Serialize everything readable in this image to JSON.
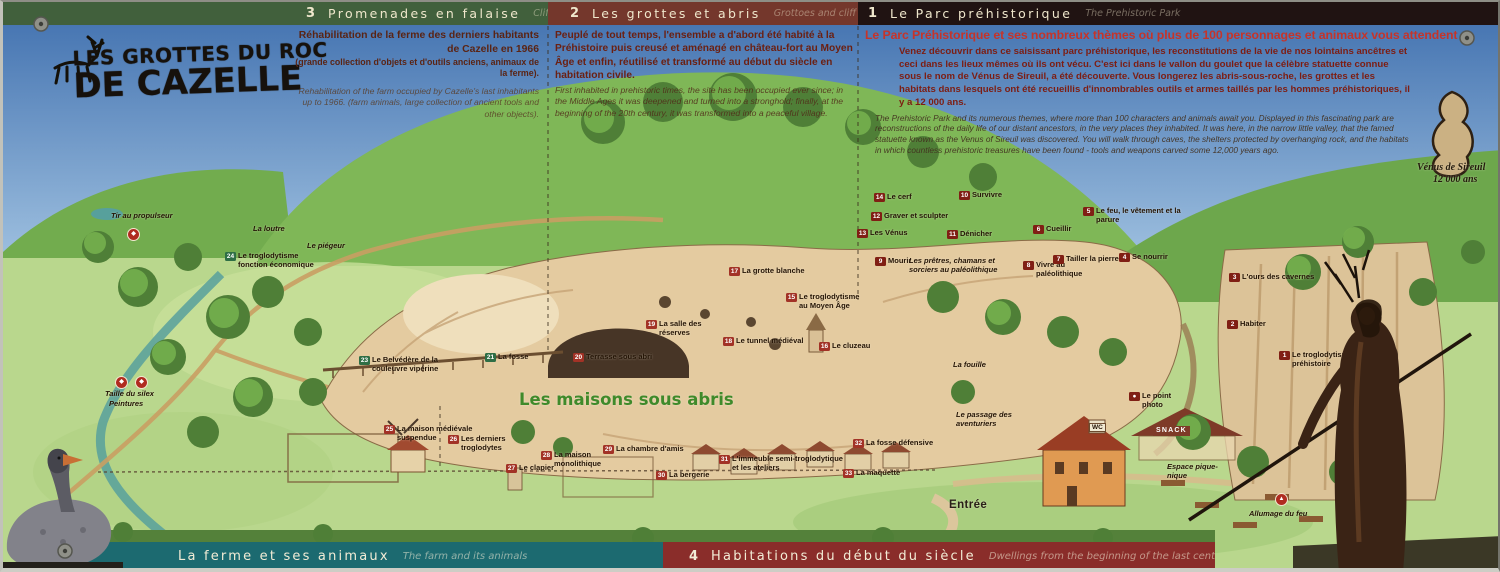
{
  "sign": {
    "title": {
      "line1": "LES GROTTES DU ROC",
      "line2": "DE CAZELLE"
    },
    "top_sections": [
      {
        "num": "3",
        "title": "Promenades en falaise",
        "title_en": "Cliff Walks",
        "fr": "Réhabilitation de la ferme des derniers habitants de Cazelle en 1966",
        "fr_note": "(grande collection d'objets et d'outils anciens, animaux de la ferme).",
        "en": "Rehabilitation of the farm occupied by Cazelle's last inhabitants up to 1966. (farm animals, large collection of ancient tools and other objects)."
      },
      {
        "num": "2",
        "title": "Les grottes et abris",
        "title_en": "Grottoes and cliff shelters",
        "fr": "Peuplé de tout temps, l'ensemble a d'abord été habité à la Préhistoire puis creusé et aménagé en château-fort au Moyen Âge et enfin, réutilisé et transformé au début du siècle en habitation civile.",
        "en": "First inhabited in prehistoric times, the site has been occupied ever since; in the Middle Ages it was deepened and turned into a stronghold; finally, at the beginning of the 20th century, it was transformed into a peaceful village."
      },
      {
        "num": "1",
        "title": "Le Parc préhistorique",
        "title_en": "The Prehistoric Park",
        "headline": "Le Parc Préhistorique et ses nombreux thèmes où plus de 100 personnages et animaux vous attendent",
        "fr": "Venez découvrir dans ce saisissant parc préhistorique, les reconstitutions de la vie de nos lointains ancêtres et ceci dans les lieux mêmes où ils ont vécu. C'est ici dans le vallon du goulet que la célèbre statuette connue sous le nom de Vénus de Sireuil, a été découverte. Vous longerez les abris-sous-roche, les grottes et les habitats dans lesquels ont été recueillis d'innombrables outils et armes taillés par les hommes préhistoriques, il y a 12 000 ans.",
        "en": "The Prehistoric Park and its numerous themes, where more than 100 characters and animals await you. Displayed in this fascinating park are reconstructions of the daily life of our distant ancestors, in the very places they inhabited. It was here, in the narrow little valley, that the famed statuette known as the Venus of Sireuil was discovered. You will walk through caves, the shelters protected by overhanging rock, and the habitats in which countless prehistoric treasures have been found - tools and weapons carved some 12,000 years ago."
      }
    ],
    "bottom_sections": [
      {
        "title": "La ferme et ses animaux",
        "title_en": "The farm and its animals"
      },
      {
        "num": "4",
        "title": "Habitations du début du siècle",
        "title_en": "Dwellings from the beginning of the last century"
      }
    ],
    "colors": {
      "band_green": "#41603c",
      "band_maroon": "#74372c",
      "band_dark": "#201312",
      "band_teal": "#1c6a70",
      "band_red": "#8a2d2a",
      "chip_green": "#2e6e45",
      "chip_red": "#a23226",
      "chip_park": "#801f14",
      "headline_red": "#c5342a"
    }
  },
  "map": {
    "labels": [
      {
        "t": "Tir au propulseur",
        "x": 108,
        "y": 210,
        "cls": "pl",
        "w": 72,
        "name": "label-tir-au-propulseur"
      },
      {
        "icon": "◆",
        "x": 124,
        "y": 226,
        "iconName": "spear-thrower-activity-icon"
      },
      {
        "t": "La loutre",
        "x": 250,
        "y": 223,
        "cls": "pl"
      },
      {
        "t": "Le piégeur",
        "x": 304,
        "y": 240,
        "cls": "pl"
      },
      {
        "n": "24",
        "c": "g",
        "t": "Le troglodytisme fonction économique",
        "x": 222,
        "y": 250,
        "w": 95
      },
      {
        "n": "23",
        "c": "g",
        "t": "Le Belvédère de la couleuvre vipérine",
        "x": 356,
        "y": 354,
        "w": 105
      },
      {
        "n": "21",
        "c": "g",
        "t": "La fosse",
        "x": 482,
        "y": 351
      },
      {
        "n": "17",
        "c": "r",
        "t": "La grotte blanche",
        "x": 726,
        "y": 265
      },
      {
        "n": "15",
        "c": "r",
        "t": "Le troglodytisme au Moyen Âge",
        "x": 783,
        "y": 291,
        "w": 80
      },
      {
        "n": "19",
        "c": "r",
        "t": "La salle des réserves",
        "x": 643,
        "y": 318,
        "w": 60
      },
      {
        "n": "18",
        "c": "r",
        "t": "Le tunnel médiéval",
        "x": 720,
        "y": 335,
        "w": 95
      },
      {
        "n": "16",
        "c": "r",
        "t": "Le cluzeau",
        "x": 816,
        "y": 340
      },
      {
        "n": "20",
        "c": "r",
        "t": "Terrasse sous abri",
        "x": 570,
        "y": 351,
        "w": 95
      },
      {
        "t": "La fouille",
        "x": 950,
        "y": 359,
        "cls": "pl"
      },
      {
        "t": "Les maisons sous abris",
        "x": 516,
        "y": 390,
        "cls": "big-green",
        "w": 320,
        "name": "label-les-maisons-sous-abris"
      },
      {
        "icon": "◆",
        "x": 112,
        "y": 374,
        "iconName": "flint-knapping-activity-icon"
      },
      {
        "icon": "◆",
        "x": 132,
        "y": 374,
        "iconName": "painting-activity-icon"
      },
      {
        "t": "Taille du silex",
        "x": 102,
        "y": 388,
        "cls": "pl",
        "w": 62
      },
      {
        "t": "Peintures",
        "x": 106,
        "y": 398,
        "cls": "pl"
      },
      {
        "n": "25",
        "c": "r",
        "t": "La maison médiévale suspendue",
        "x": 381,
        "y": 423,
        "w": 90
      },
      {
        "n": "26",
        "c": "r",
        "t": "Les derniers troglodytes",
        "x": 445,
        "y": 433,
        "w": 72
      },
      {
        "n": "27",
        "c": "r",
        "t": "Le clapier",
        "x": 503,
        "y": 462
      },
      {
        "n": "28",
        "c": "r",
        "t": "La maison monolithique",
        "x": 538,
        "y": 449,
        "w": 74
      },
      {
        "n": "29",
        "c": "r",
        "t": "La chambre d'amis",
        "x": 600,
        "y": 443,
        "w": 92
      },
      {
        "n": "30",
        "c": "r",
        "t": "La bergerie",
        "x": 653,
        "y": 469
      },
      {
        "n": "31",
        "c": "r",
        "t": "L'immeuble semi-troglodytique et les ateliers",
        "x": 716,
        "y": 453,
        "w": 125
      },
      {
        "n": "32",
        "c": "r",
        "t": "La fosse défensive",
        "x": 850,
        "y": 437,
        "w": 95
      },
      {
        "n": "33",
        "c": "r",
        "t": "La maquette",
        "x": 840,
        "y": 467
      },
      {
        "n": "14",
        "c": "p",
        "t": "Le cerf",
        "x": 871,
        "y": 191
      },
      {
        "n": "12",
        "c": "p",
        "t": "Graver et sculpter",
        "x": 868,
        "y": 210,
        "w": 85
      },
      {
        "n": "13",
        "c": "p",
        "t": "Les Vénus",
        "x": 854,
        "y": 227
      },
      {
        "n": "10",
        "c": "p",
        "t": "Survivre",
        "x": 956,
        "y": 189
      },
      {
        "n": "11",
        "c": "p",
        "t": "Dénicher",
        "x": 944,
        "y": 228
      },
      {
        "n": "9",
        "c": "p",
        "t": "Mourir",
        "x": 872,
        "y": 255
      },
      {
        "t": "Les prêtres, chamans et sorciers au paléolithique",
        "x": 906,
        "y": 255,
        "cls": "pl",
        "w": 110
      },
      {
        "n": "8",
        "c": "p",
        "t": "Vivre au paléolithique",
        "x": 1020,
        "y": 259,
        "w": 68
      },
      {
        "n": "6",
        "c": "p",
        "t": "Cueillir",
        "x": 1030,
        "y": 223
      },
      {
        "n": "7",
        "c": "p",
        "t": "Tailler la pierre",
        "x": 1050,
        "y": 253,
        "w": 72
      },
      {
        "n": "5",
        "c": "p",
        "t": "Le feu, le vêtement et la parure",
        "x": 1080,
        "y": 205,
        "w": 98
      },
      {
        "n": "4",
        "c": "p",
        "t": "Se nourrir",
        "x": 1116,
        "y": 251
      },
      {
        "n": "3",
        "c": "p",
        "t": "L'ours des cavernes",
        "x": 1226,
        "y": 271,
        "w": 95
      },
      {
        "n": "2",
        "c": "p",
        "t": "Habiter",
        "x": 1224,
        "y": 318
      },
      {
        "n": "1",
        "c": "p",
        "t": "Le troglodytisme durant la préhistoire",
        "x": 1276,
        "y": 349,
        "w": 112
      },
      {
        "n": "●",
        "c": "p",
        "t": "Le point photo",
        "x": 1126,
        "y": 390,
        "w": 46,
        "name": "label-photo-point"
      },
      {
        "t": "Le passage des aventuriers",
        "x": 953,
        "y": 409,
        "cls": "pl",
        "w": 80
      },
      {
        "t": "WC",
        "x": 1086,
        "y": 421,
        "cls": "wc"
      },
      {
        "t": "SNACK",
        "x": 1150,
        "y": 424,
        "cls": "snack"
      },
      {
        "t": "Espace pique-nique",
        "x": 1164,
        "y": 461,
        "cls": "pl",
        "w": 60
      },
      {
        "t": "Entrée",
        "x": 946,
        "y": 498,
        "cls": "big-dark"
      },
      {
        "icon": "▲",
        "x": 1272,
        "y": 491,
        "iconName": "fire-lighting-icon"
      },
      {
        "t": "Allumage du feu",
        "x": 1246,
        "y": 508,
        "cls": "pl",
        "w": 95
      },
      {
        "t": "Vénus de Sireuil",
        "x": 1414,
        "y": 161,
        "cls": "venus",
        "name": "label-venus-de-sireuil"
      },
      {
        "t": "12 000 ans",
        "x": 1430,
        "y": 173,
        "cls": "venus"
      }
    ]
  }
}
